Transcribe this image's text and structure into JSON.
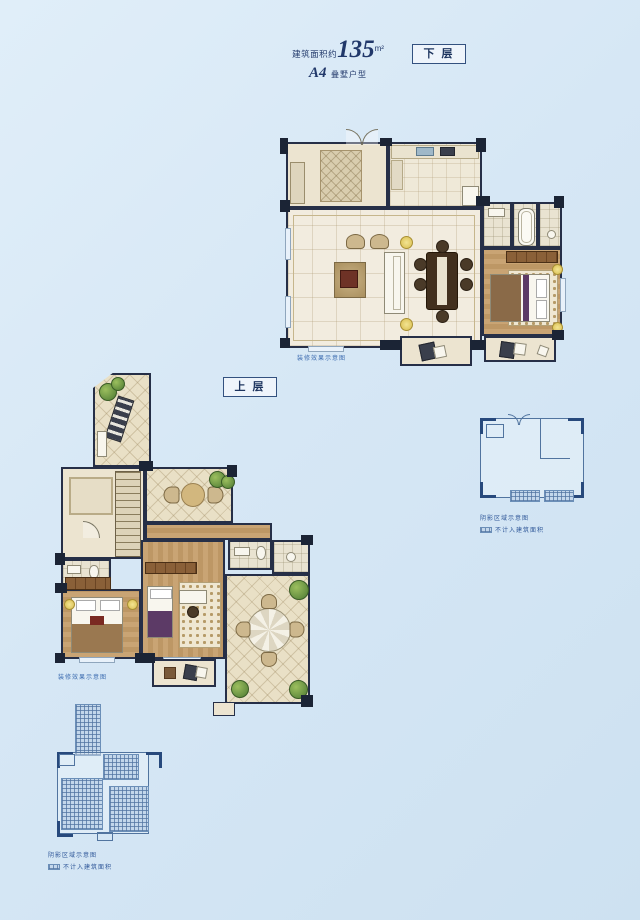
{
  "header": {
    "area_prefix": "建筑面积约",
    "area_value": "135",
    "area_unit": "m²",
    "model_code": "A4",
    "model_type": "叠墅户型"
  },
  "floor_labels": {
    "lower": "下 层",
    "upper": "上 层"
  },
  "captions": {
    "render_note": "装修效果示意图",
    "keyplan_note": "阴影区域示意图",
    "keyplan_area_note": "不计入建筑面积"
  },
  "colors": {
    "background": "#d6e7f5",
    "ink": "#21386a",
    "wall": "#1d2636",
    "floor_cream": "#ece4d0",
    "wood": "#c49e6e",
    "keyplan_line": "#51749f",
    "hatch_fill": "#c3d7eb"
  }
}
